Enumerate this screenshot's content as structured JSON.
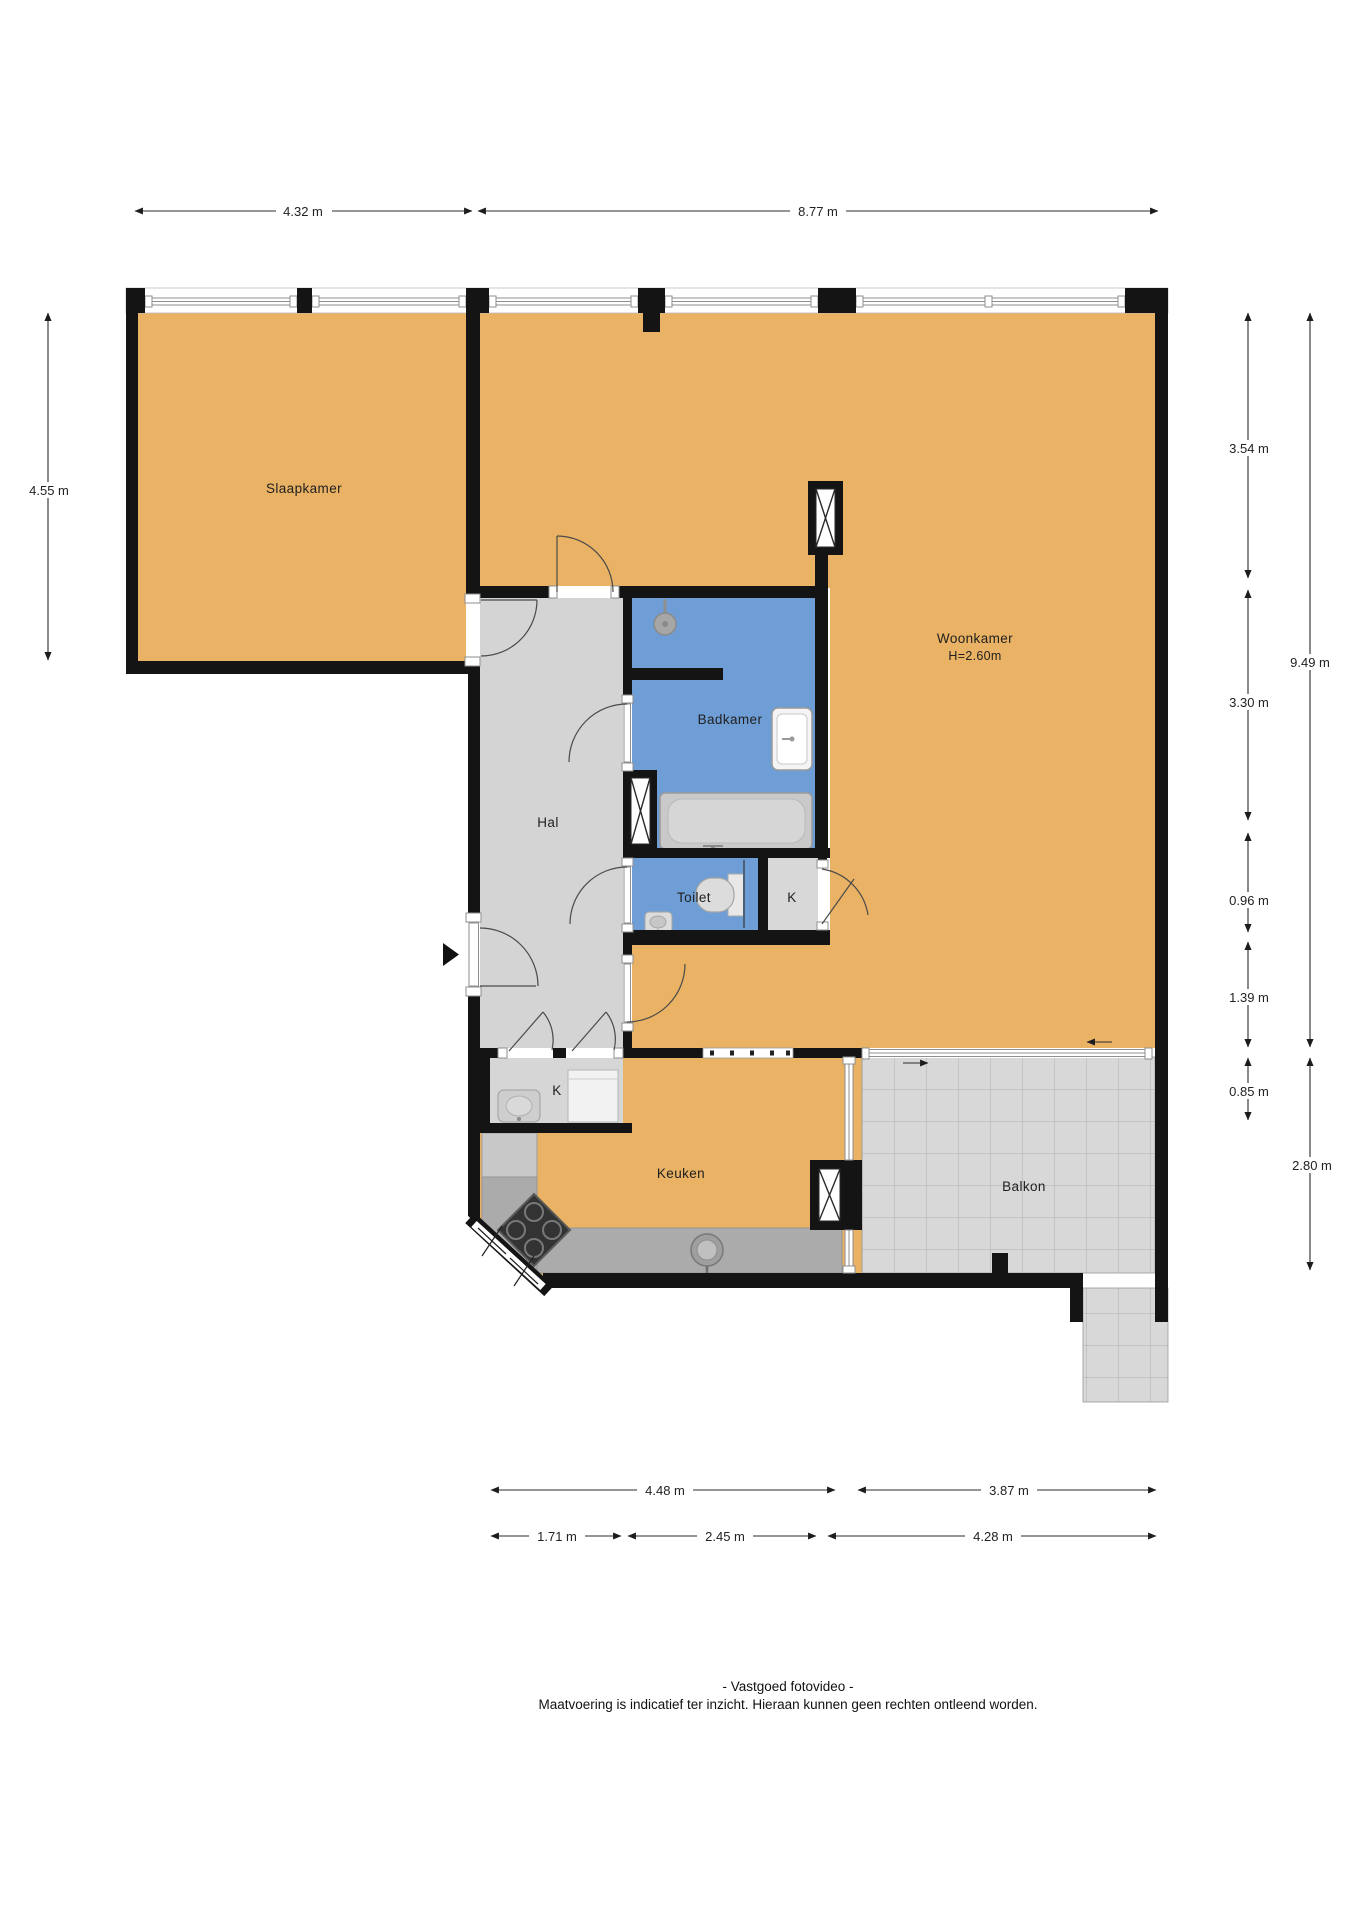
{
  "plan": {
    "rooms": {
      "slaapkamer": {
        "label": "Slaapkamer"
      },
      "woonkamer": {
        "label": "Woonkamer",
        "height_note": "H=2.60m"
      },
      "badkamer": {
        "label": "Badkamer"
      },
      "hal": {
        "label": "Hal"
      },
      "toilet": {
        "label": "Toilet"
      },
      "kast_boven": {
        "label": "K"
      },
      "kast_onder": {
        "label": "K"
      },
      "keuken": {
        "label": "Keuken"
      },
      "balkon": {
        "label": "Balkon"
      }
    },
    "dimensions": {
      "top": [
        "4.32 m",
        "8.77 m"
      ],
      "left": [
        "4.55 m"
      ],
      "right_inner": [
        "3.54 m",
        "3.30 m",
        "0.96 m",
        "1.39 m",
        "0.85 m"
      ],
      "right_outer": [
        "9.49 m",
        "2.80 m"
      ],
      "bottom_upper": [
        "4.48 m",
        "3.87 m"
      ],
      "bottom_lower": [
        "1.71 m",
        "2.45 m",
        "4.28 m"
      ]
    },
    "footer": {
      "line1": "- Vastgoed fotovideo -",
      "line2": "Maatvoering is indicatief ter inzicht. Hieraan kunnen geen rechten ontleend worden."
    },
    "icons": [
      "shower-icon",
      "bathtub-icon",
      "washbasin-icon",
      "toilet-icon",
      "small-basin-icon",
      "boiler-icon",
      "appliance-icon",
      "stove-icon",
      "sink-icon",
      "shaft-icon",
      "entrance-arrow-icon",
      "slide-direction-arrow-icon"
    ],
    "colors": {
      "floor_orange": "#e9b264",
      "wet_room_blue": "#6f9ed6",
      "hall_gray": "#d4d4d4",
      "tile_gray": "#d8d8d8",
      "counter_gray": "#a9a9a9",
      "wall_black": "#141414"
    }
  }
}
